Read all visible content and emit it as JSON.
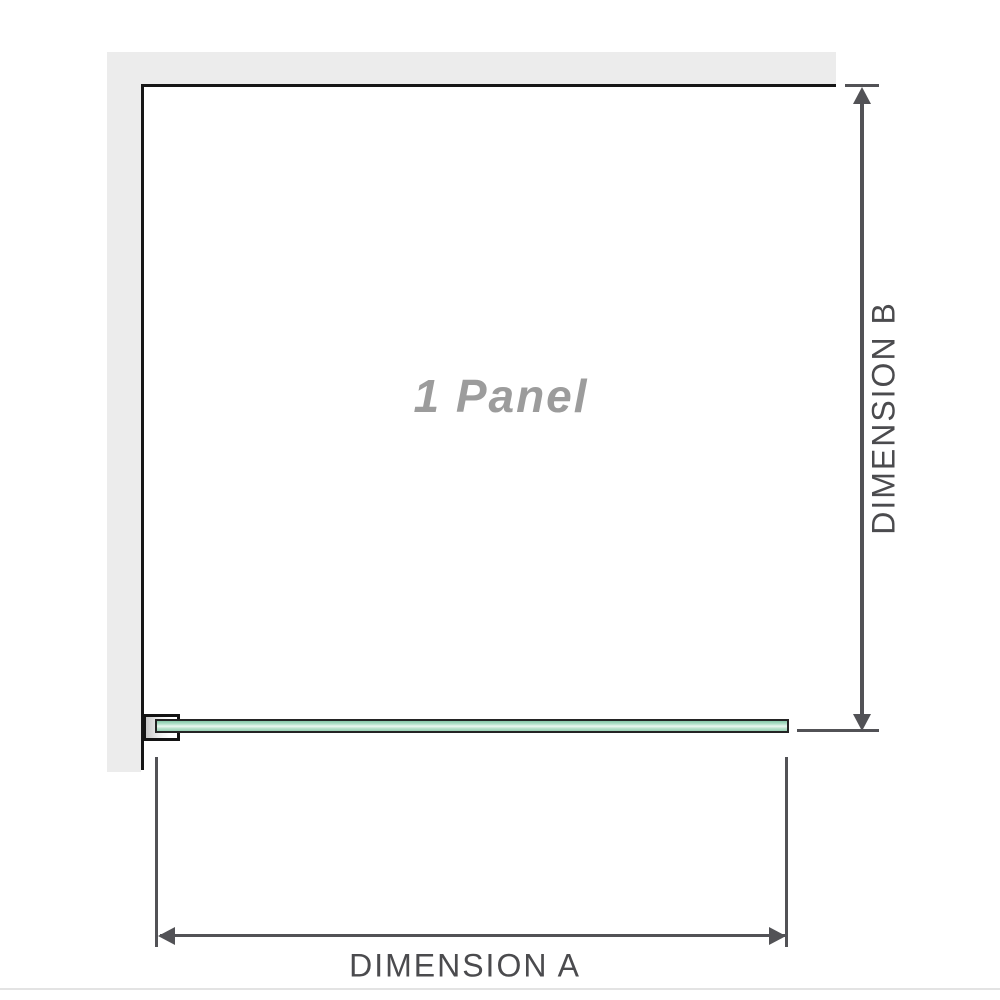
{
  "diagram": {
    "panel_label": "1 Panel",
    "dimension_a_label": "DIMENSION A",
    "dimension_b_label": "DIMENSION B",
    "icons": {
      "dim_b_top": "arrow-up-icon",
      "dim_b_bottom": "arrow-down-icon",
      "dim_a_left": "arrow-left-icon",
      "dim_a_right": "arrow-right-icon"
    },
    "colors": {
      "background": "#ffffff",
      "wall_fill": "#ececec",
      "wall_edge": "#161616",
      "glass_border": "#242424",
      "glass_green_dark": "#86c7a8",
      "glass_green_mid": "#b4e2cb",
      "glass_green_light": "#ecf8f1",
      "dimension_line": "#525256",
      "dimension_label_text": "#4b4b4e",
      "panel_label_text": "#9c9c9c",
      "baseline_line": "#e3e3e3"
    }
  }
}
